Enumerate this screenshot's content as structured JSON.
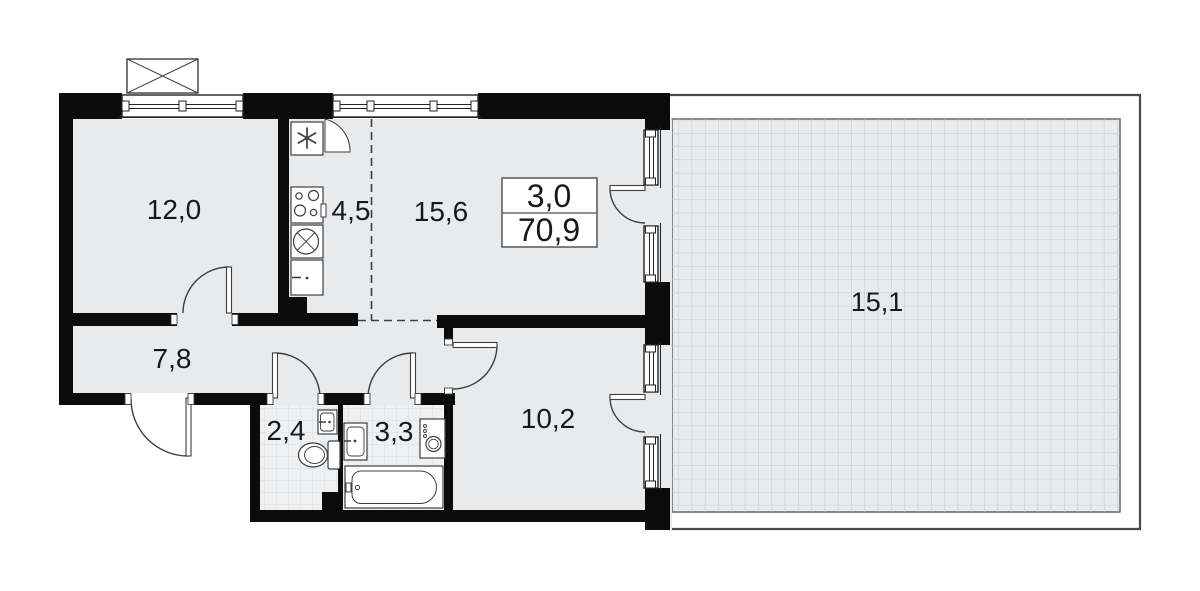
{
  "plan_title": "3-room apartment floor plan",
  "summary": {
    "rooms_count": "3,0",
    "total_area": "70,9"
  },
  "rooms": [
    {
      "name": "room-1",
      "area": "12,0"
    },
    {
      "name": "kitchen",
      "area": "4,5"
    },
    {
      "name": "living-room",
      "area": "15,6"
    },
    {
      "name": "hallway",
      "area": "7,8"
    },
    {
      "name": "wc",
      "area": "2,4"
    },
    {
      "name": "bathroom",
      "area": "3,3"
    },
    {
      "name": "bedroom",
      "area": "10,2"
    },
    {
      "name": "terrace",
      "area": "15,1"
    }
  ],
  "icons": [
    {
      "name": "snowflake-icon",
      "meaning": "fridge"
    },
    {
      "name": "stove-icon",
      "meaning": "cooktop with 4 burners"
    },
    {
      "name": "sink-cross-icon",
      "meaning": "kitchen sink"
    },
    {
      "name": "toilet-icon",
      "meaning": "toilet"
    },
    {
      "name": "washbasin-icon",
      "meaning": "washbasin"
    },
    {
      "name": "washing-machine-icon",
      "meaning": "washing machine"
    },
    {
      "name": "bathtub-icon",
      "meaning": "bathtub"
    },
    {
      "name": "balcony-cross-icon",
      "meaning": "external unit / balcony box"
    }
  ],
  "colors": {
    "wall": "#0b0b0c",
    "floor": "#e8eaec",
    "tile_floor": "#eef0f2",
    "tile_line": "#d9dcdf",
    "terrace_line": "#c7ccd1",
    "outline": "#3c3e40",
    "text": "#17181a",
    "background": "#ffffff"
  }
}
